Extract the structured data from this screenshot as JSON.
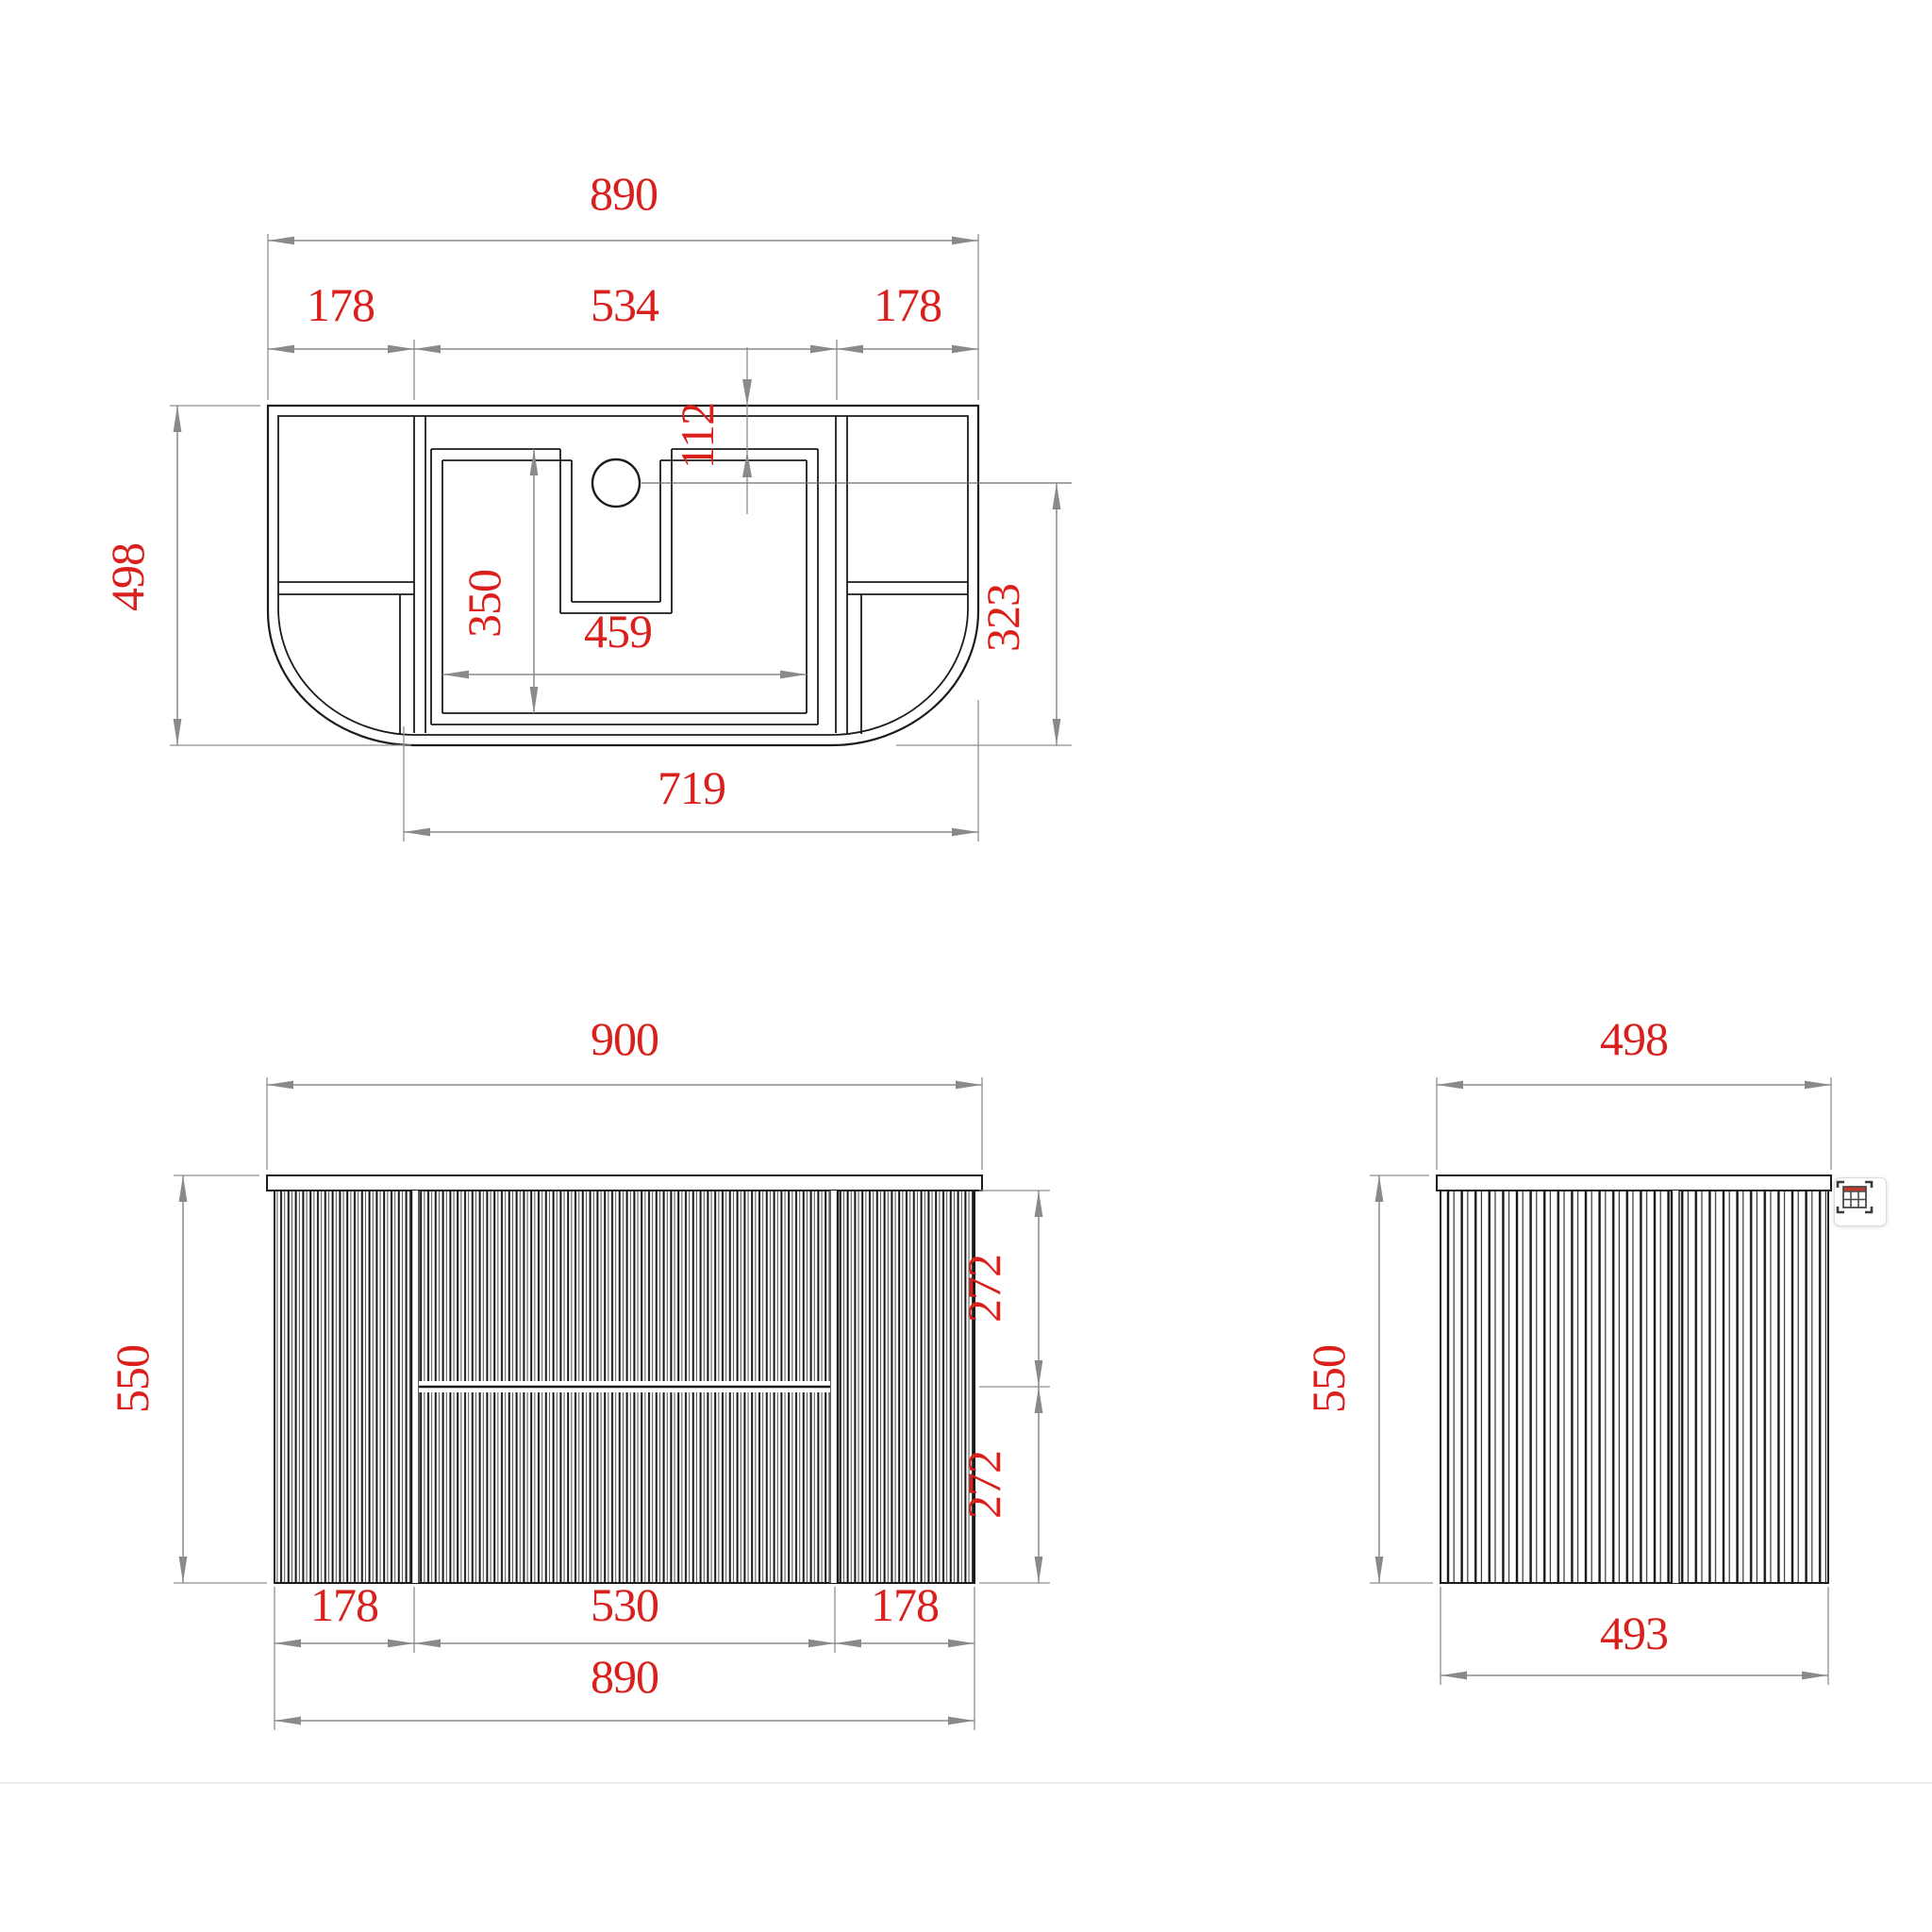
{
  "palette": {
    "background": "#ffffff",
    "drawing_line": "#1b1b1b",
    "dimension_line": "#8a8a8a",
    "dimension_text": "#d9201c",
    "separator": "#ececec",
    "icon_accent": "#c5392b"
  },
  "views": {
    "plan": {
      "overall_width": "890",
      "left_section": "178",
      "center_section": "534",
      "right_section": "178",
      "hole_inset": "112",
      "overall_depth": "498",
      "basin_cutout_depth": "350",
      "basin_cutout_width": "459",
      "hole_to_front": "323",
      "open_base_width": "719"
    },
    "front": {
      "overall_width": "900",
      "overall_height": "550",
      "upper_drawer_height": "272",
      "lower_drawer_height": "272",
      "left_door_width": "178",
      "drawer_front_width": "530",
      "right_door_width": "178",
      "carcass_width": "890"
    },
    "side": {
      "top_depth": "498",
      "overall_height": "550",
      "carcass_depth": "493"
    }
  },
  "overlay_button": {
    "icon": "capture-table-icon"
  }
}
